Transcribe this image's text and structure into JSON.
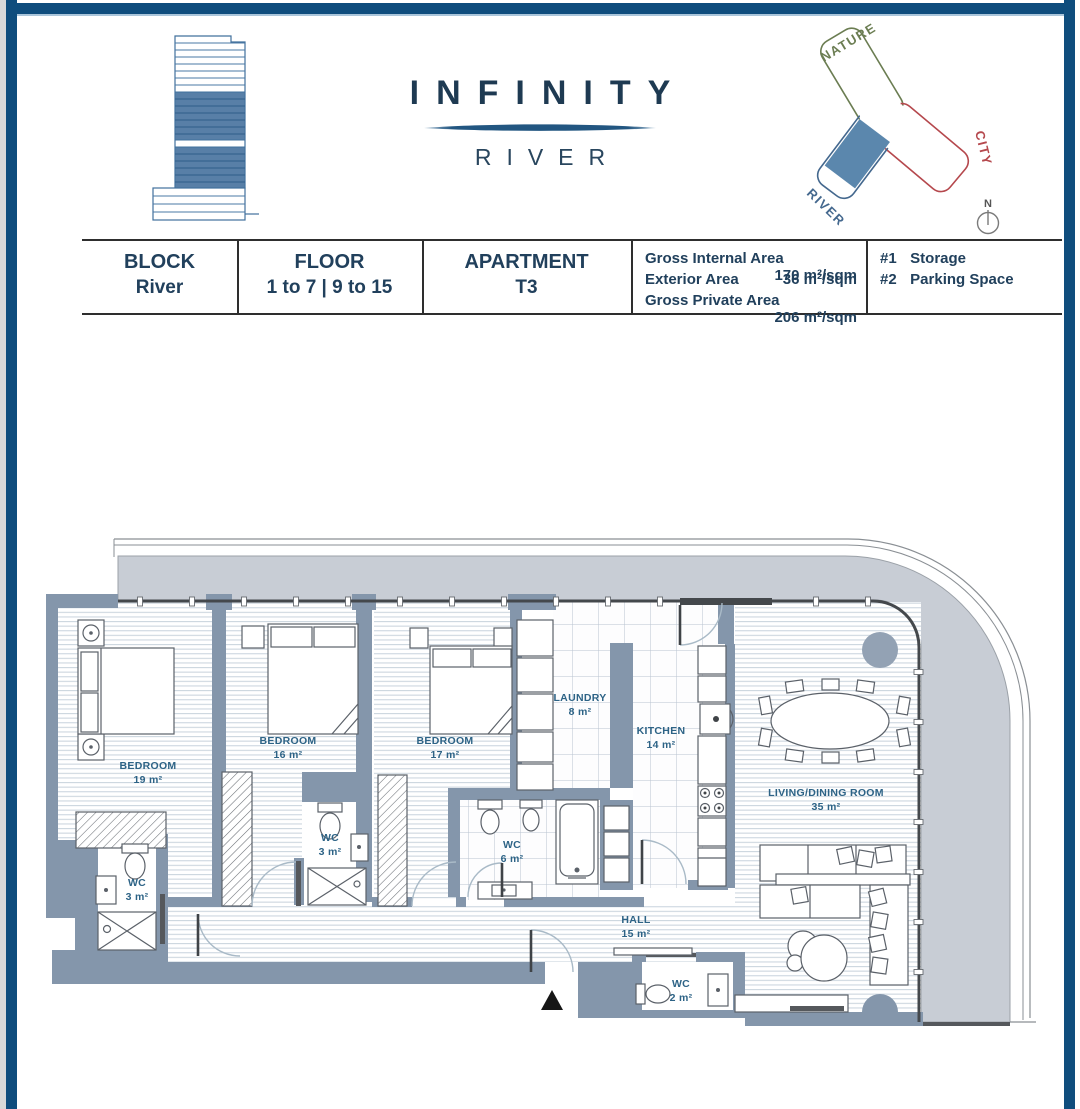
{
  "brand": {
    "title": "INFINITY",
    "subtitle": "RIVER"
  },
  "site_plan": {
    "nature_label": "NATURE",
    "city_label": "CITY",
    "river_label": "RIVER",
    "compass_label": "N",
    "nature_color": "#6b7d52",
    "city_color": "#b5484d",
    "river_color": "#44688e",
    "highlight_color": "#5b87ad"
  },
  "info_table": {
    "block": {
      "label": "BLOCK",
      "value": "River"
    },
    "floor": {
      "label": "FLOOR",
      "value": "1 to 7 | 9 to 15"
    },
    "apartment": {
      "label": "APARTMENT",
      "value": "T3"
    },
    "areas": [
      {
        "label": "Gross Internal Area",
        "value": "170 m²/sqm"
      },
      {
        "label": "Exterior Area",
        "value": "36 m²/sqm"
      },
      {
        "label": "Gross Private Area",
        "value": "206 m²/sqm"
      }
    ],
    "extras": [
      {
        "label": "#1",
        "value": "Storage"
      },
      {
        "label": "#2",
        "value": "Parking Space"
      }
    ]
  },
  "floor_plan": {
    "rooms": [
      {
        "name": "BEDROOM",
        "area": "19 m²"
      },
      {
        "name": "BEDROOM",
        "area": "16 m²"
      },
      {
        "name": "BEDROOM",
        "area": "17 m²"
      },
      {
        "name": "LAUNDRY",
        "area": "8 m²"
      },
      {
        "name": "KITCHEN",
        "area": "14 m²"
      },
      {
        "name": "WC",
        "area": "3 m²"
      },
      {
        "name": "WC",
        "area": "3 m²"
      },
      {
        "name": "WC",
        "area": "6 m²"
      },
      {
        "name": "HALL",
        "area": "15 m²"
      },
      {
        "name": "WC",
        "area": "2 m²"
      },
      {
        "name": "LIVING/DINING ROOM",
        "area": "35 m²"
      }
    ],
    "colors": {
      "wall": "#8496ab",
      "terrace": "#c8cdd5",
      "label": "#2d6386"
    }
  }
}
